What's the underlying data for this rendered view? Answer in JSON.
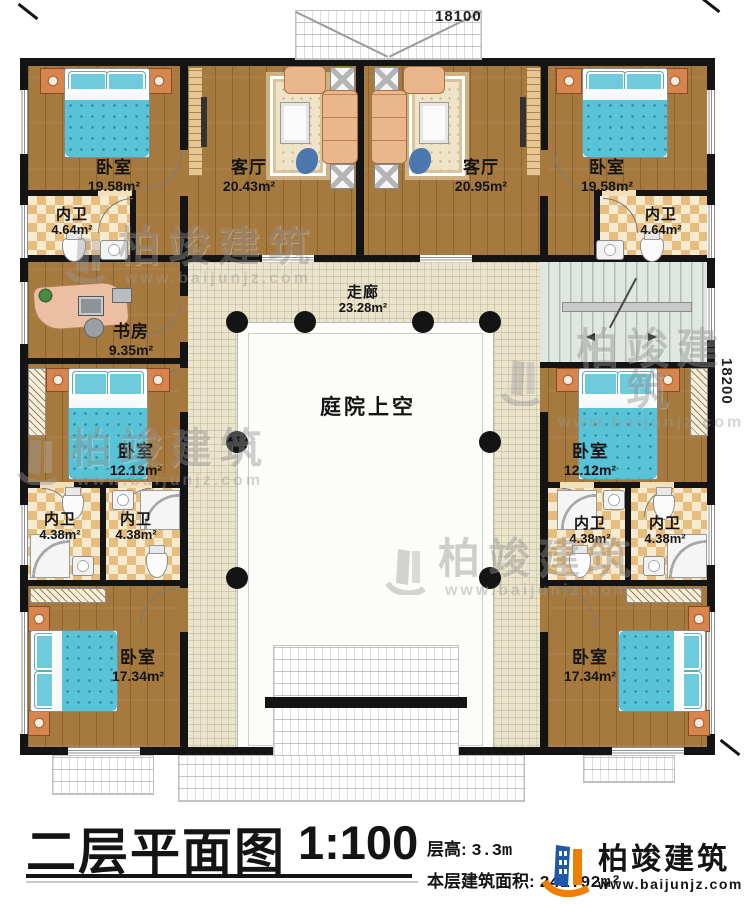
{
  "plan": {
    "dimensions": {
      "top": "18100",
      "right": "18200"
    },
    "corridor": {
      "name": "走廊",
      "area": "23.28m²"
    },
    "courtyard": {
      "name": "庭院上空"
    },
    "rooms": {
      "bedroom_tl": {
        "name": "卧室",
        "area": "19.58m²"
      },
      "living_l": {
        "name": "客厅",
        "area": "20.43m²"
      },
      "living_r": {
        "name": "客厅",
        "area": "20.95m²"
      },
      "bedroom_tr": {
        "name": "卧室",
        "area": "19.58m²"
      },
      "bath_tl": {
        "name": "内卫",
        "area": "4.64m²"
      },
      "bath_tr": {
        "name": "内卫",
        "area": "4.64m²"
      },
      "study": {
        "name": "书房",
        "area": "9.35m²"
      },
      "bedroom_ml": {
        "name": "卧室",
        "area": "12.12m²"
      },
      "bedroom_mr": {
        "name": "卧室",
        "area": "12.12m²"
      },
      "bath_ml1": {
        "name": "内卫",
        "area": "4.38m²"
      },
      "bath_ml2": {
        "name": "内卫",
        "area": "4.38m²"
      },
      "bath_mr1": {
        "name": "内卫",
        "area": "4.38m²"
      },
      "bath_mr2": {
        "name": "内卫",
        "area": "4.38m²"
      },
      "bedroom_bl": {
        "name": "卧室",
        "area": "17.34m²"
      },
      "bedroom_br": {
        "name": "卧室",
        "area": "17.34m²"
      }
    },
    "watermark": {
      "brand": "柏竣建筑",
      "url": "www.baijunjz.com"
    }
  },
  "titleblock": {
    "title": "二层平面图",
    "scale": "1:100",
    "floor_height_label": "层高:",
    "floor_height_value": "3.3m",
    "floor_area_label": "本层建筑面积:",
    "floor_area_value": "241.92m²",
    "logo": {
      "brand": "柏竣建筑",
      "url": "www.baijunjz.com"
    }
  },
  "colors": {
    "wall": "#141414",
    "wood_floor": "#a6793e",
    "corridor_floor": "#eae4cc",
    "bath_checker": "#e6bd7d",
    "bed_blanket": "#58c3d6",
    "logo_orange": "#f07f00",
    "logo_blue": "#1f5aa8"
  }
}
